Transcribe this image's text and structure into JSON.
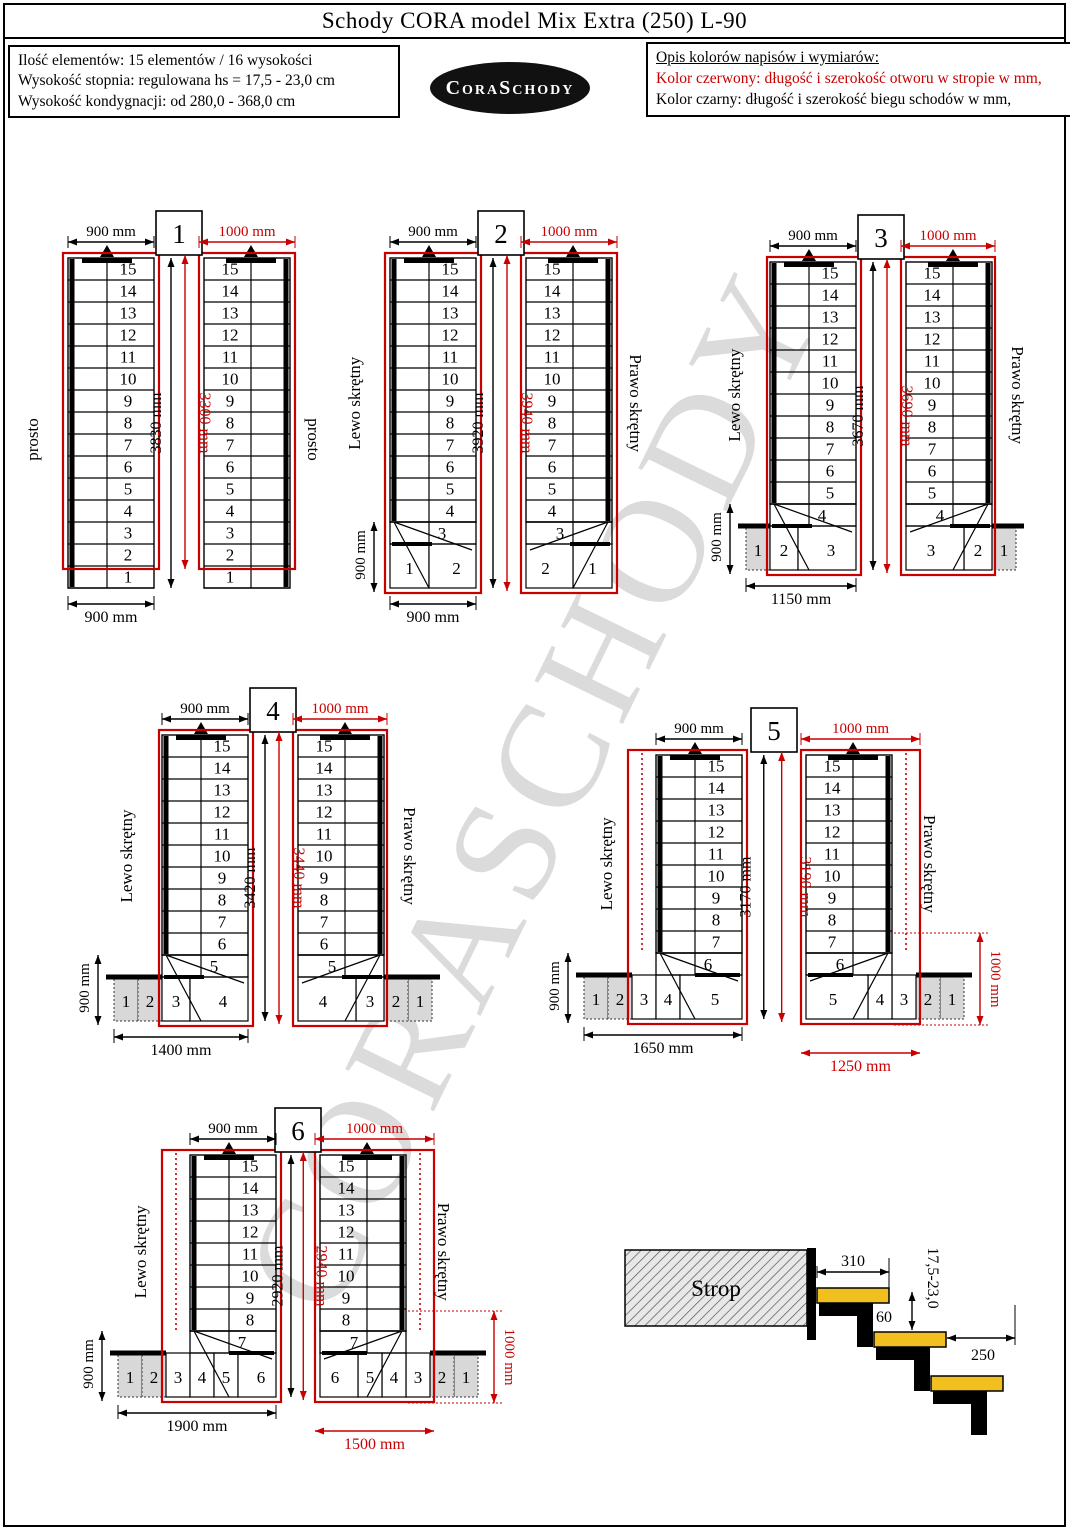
{
  "title": "Schody CORA model Mix Extra (250) L-90",
  "info_box": {
    "lines": [
      "Ilość elementów: 15 elementów / 16 wysokości",
      "Wysokość stopnia: regulowana  hs = 17,5 - 23,0 cm",
      "Wysokość kondygnacji: od 280,0 - 368,0 cm"
    ]
  },
  "logo_text": "CoraSchody",
  "legend": {
    "heading": "Opis kolorów napisów i wymiarów:",
    "red_line": "Kolor czerwony:  długość i szerokość otworu w stropie w mm,",
    "black_line": "Kolor czarny:  długość i szerokość biegu schodów w mm,"
  },
  "watermark": "CORASCHODY",
  "colors": {
    "red": "#c90000",
    "gray_fill": "#d8d8d8",
    "tread_yellow": "#f2c01e",
    "watermark_gray": "#c4c4c4"
  },
  "diagrams": [
    {
      "number": "1",
      "left_label": "prosto",
      "right_label": "prosto",
      "top_dim_black": "900 mm",
      "top_dim_red": "1000 mm",
      "length_dim_black": "3830 mm",
      "length_dim_red": "3300 mm",
      "side_dim_black": null,
      "side_dim_red": null,
      "bottom_dim_black": "900 mm",
      "bottom_dim_red": null,
      "straight_from": 15,
      "straight_to": 1,
      "trap_step": null,
      "white_steps": [],
      "big_step": null,
      "gray_steps": []
    },
    {
      "number": "2",
      "left_label": "Lewo skrętny",
      "right_label": "Prawo skrętny",
      "top_dim_black": "900 mm",
      "top_dim_red": "1000 mm",
      "length_dim_black": "3920 mm",
      "length_dim_red": "3940 mm",
      "side_dim_black": "900 mm",
      "side_dim_red": null,
      "bottom_dim_black": "900 mm",
      "bottom_dim_red": null,
      "straight_from": 15,
      "straight_to": 4,
      "trap_step": 3,
      "white_steps": [
        1
      ],
      "big_step": 2,
      "gray_steps": []
    },
    {
      "number": "3",
      "left_label": "Lewo skrętny",
      "right_label": "Prawo skrętny",
      "top_dim_black": "900 mm",
      "top_dim_red": "1000 mm",
      "length_dim_black": "3670 mm",
      "length_dim_red": "3690 mm",
      "side_dim_black": "900 mm",
      "side_dim_red": null,
      "bottom_dim_black": "1150 mm",
      "bottom_dim_red": null,
      "straight_from": 15,
      "straight_to": 5,
      "trap_step": 4,
      "white_steps": [
        2
      ],
      "big_step": 3,
      "gray_steps": [
        1
      ]
    },
    {
      "number": "4",
      "left_label": "Lewo skrętny",
      "right_label": "Prawo skrętny",
      "top_dim_black": "900 mm",
      "top_dim_red": "1000 mm",
      "length_dim_black": "3420 mm",
      "length_dim_red": "3440 mm",
      "side_dim_black": "900 mm",
      "side_dim_red": null,
      "bottom_dim_black": "1400 mm",
      "bottom_dim_red": null,
      "straight_from": 15,
      "straight_to": 6,
      "trap_step": 5,
      "white_steps": [
        3
      ],
      "big_step": 4,
      "gray_steps": [
        1,
        2
      ]
    },
    {
      "number": "5",
      "left_label": "Lewo skrętny",
      "right_label": "Prawo skrętny",
      "top_dim_black": "900 mm",
      "top_dim_red": "1000 mm",
      "length_dim_black": "3170 mm",
      "length_dim_red": "3190 mm",
      "side_dim_black": "900 mm",
      "side_dim_red": "1000 mm",
      "bottom_dim_black": "1650 mm",
      "bottom_dim_red": "1250 mm",
      "straight_from": 15,
      "straight_to": 7,
      "trap_step": 6,
      "white_steps": [
        3,
        4
      ],
      "big_step": 5,
      "gray_steps": [
        1,
        2
      ]
    },
    {
      "number": "6",
      "left_label": "Lewo skrętny",
      "right_label": "Prawo skrętny",
      "top_dim_black": "900 mm",
      "top_dim_red": "1000 mm",
      "length_dim_black": "2920 mm",
      "length_dim_red": "2940 mm",
      "side_dim_black": "900 mm",
      "side_dim_red": "1000 mm",
      "bottom_dim_black": "1900 mm",
      "bottom_dim_red": "1500 mm",
      "straight_from": 15,
      "straight_to": 8,
      "trap_step": 7,
      "white_steps": [
        3,
        4,
        5
      ],
      "big_step": 6,
      "gray_steps": [
        1,
        2
      ]
    }
  ],
  "section_detail": {
    "slab_label": "Strop",
    "tread_depth": "310",
    "rise_range": "17,5-23,0",
    "overlap": "60",
    "going": "250"
  }
}
